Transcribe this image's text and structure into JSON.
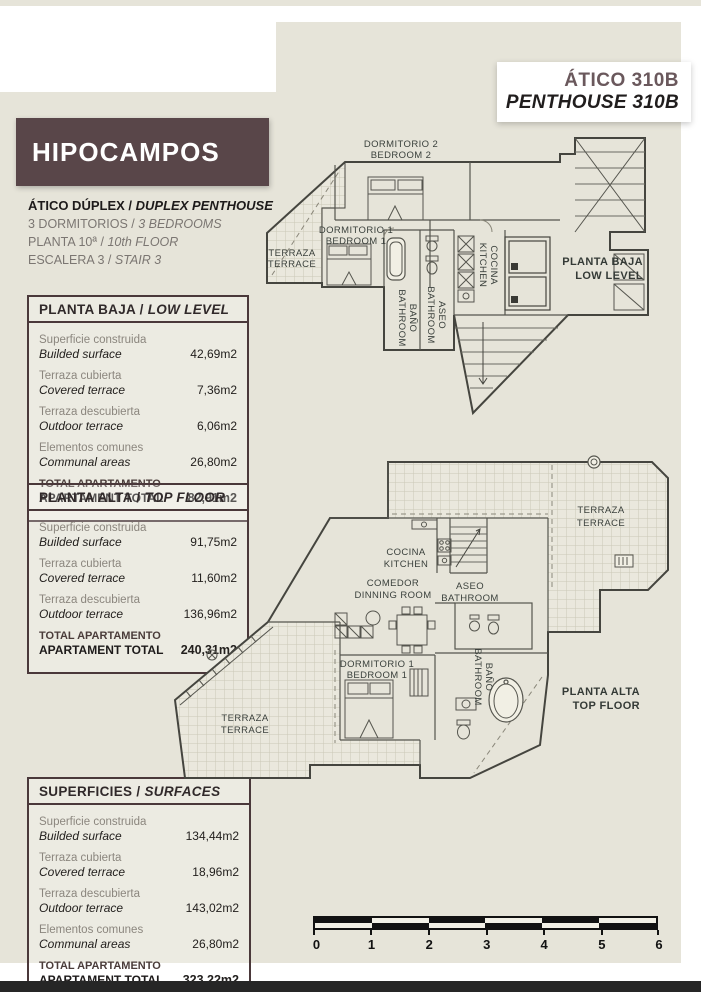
{
  "sep": " / ",
  "colors": {
    "panel_beige": "#e6e4d9",
    "brand_brown": "#594649",
    "table_border": "#4a383a",
    "unit_title_brown": "#6a585c",
    "footer_bar": "#262626"
  },
  "header": {
    "unit_es": "ÁTICO 310B",
    "unit_en": "PENTHOUSE 310B",
    "brand": "HIPOCAMPOS"
  },
  "info": [
    {
      "es": "ÁTICO DÚPLEX",
      "en": "DUPLEX PENTHOUSE"
    },
    {
      "es": "3 DORMITORIOS",
      "en": "3 BEDROOMS"
    },
    {
      "es": "PLANTA 10ª",
      "en": "10th FLOOR"
    },
    {
      "es": "ESCALERA 3",
      "en": "STAIR 3"
    }
  ],
  "tables": [
    {
      "title_es": "PLANTA BAJA",
      "title_en": "LOW LEVEL",
      "rows": [
        {
          "label_es": "Superficie construida",
          "label_en": "Builded surface",
          "value": "42,69m2"
        },
        {
          "label_es": "Terraza cubierta",
          "label_en": "Covered terrace",
          "value": "7,36m2"
        },
        {
          "label_es": "Terraza descubierta",
          "label_en": "Outdoor terrace",
          "value": "6,06m2"
        },
        {
          "label_es": "Elementos comunes",
          "label_en": "Communal areas",
          "value": "26,80m2"
        }
      ],
      "total": {
        "line1": "TOTAL APARTAMENTO",
        "line2": "APARTAMENT TOTAL",
        "value": "82,91m2"
      }
    },
    {
      "title_es": "PLANTA ALTA",
      "title_en": "TOP FLOOR",
      "rows": [
        {
          "label_es": "Superficie construida",
          "label_en": "Builded surface",
          "value": "91,75m2"
        },
        {
          "label_es": "Terraza cubierta",
          "label_en": "Covered terrace",
          "value": "11,60m2"
        },
        {
          "label_es": "Terraza descubierta",
          "label_en": "Outdoor terrace",
          "value": "136,96m2"
        }
      ],
      "total": {
        "line1": "TOTAL APARTAMENTO",
        "line2": "APARTAMENT TOTAL",
        "value": "240,31m2"
      }
    },
    {
      "title_es": "SUPERFICIES",
      "title_en": "SURFACES",
      "rows": [
        {
          "label_es": "Superficie construida",
          "label_en": "Builded surface",
          "value": "134,44m2"
        },
        {
          "label_es": "Terraza cubierta",
          "label_en": "Covered terrace",
          "value": "18,96m2"
        },
        {
          "label_es": "Terraza descubierta",
          "label_en": "Outdoor terrace",
          "value": "143,02m2"
        },
        {
          "label_es": "Elementos comunes",
          "label_en": "Communal areas",
          "value": "26,80m2"
        }
      ],
      "total": {
        "line1": "TOTAL APARTAMENTO",
        "line2": "APARTAMENT TOTAL",
        "value": "323,22m2"
      }
    }
  ],
  "plans": {
    "low": {
      "title_es": "PLANTA BAJA",
      "title_en": "LOW LEVEL",
      "dorm2_es": "DORMITORIO 2",
      "dorm2_en": "BEDROOM 2",
      "dorm1_es": "DORMITORIO 1",
      "dorm1_en": "BEDROOM 1",
      "terraza_es": "TERRAZA",
      "terraza_en": "TERRACE",
      "bano_es": "BAÑO",
      "bano_en": "BATHROOM",
      "aseo_es": "ASEO",
      "aseo_en": "BATHROOM",
      "cocina_es": "COCINA",
      "cocina_en": "KITCHEN"
    },
    "top": {
      "title_es": "PLANTA ALTA",
      "title_en": "TOP FLOOR",
      "terraza_upper_es": "TERRAZA",
      "terraza_upper_en": "TERRACE",
      "cocina_es": "COCINA",
      "cocina_en": "KITCHEN",
      "comedor_es": "COMEDOR",
      "comedor_en": "DINNING ROOM",
      "aseo_es": "ASEO",
      "aseo_en": "BATHROOM",
      "dorm1_es": "DORMITORIO 1",
      "dorm1_en": "BEDROOM 1",
      "bano_es": "BAÑO",
      "bano_en": "BATHROOM",
      "terraza_lower_es": "TERRAZA",
      "terraza_lower_en": "TERRACE"
    }
  },
  "scalebar": {
    "labels": [
      "0",
      "1",
      "2",
      "3",
      "4",
      "5",
      "6"
    ]
  }
}
